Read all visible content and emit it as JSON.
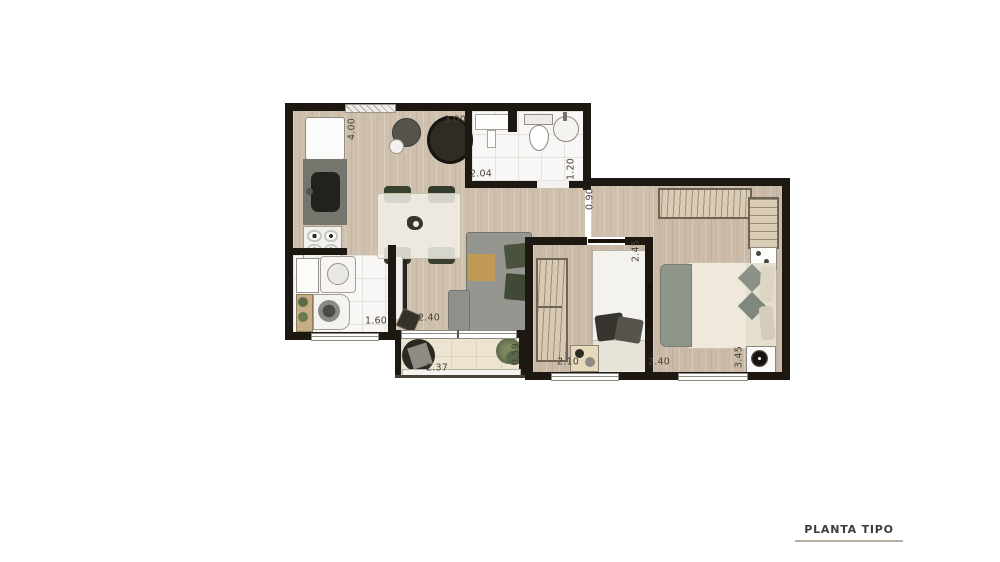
{
  "title": {
    "label": "PLANTA TIPO"
  },
  "dimensions": [
    {
      "id": "kitchen-depth",
      "value": "4.00",
      "orientation": "vertical"
    },
    {
      "id": "living-width",
      "value": "3.00",
      "orientation": "horizontal"
    },
    {
      "id": "bathroom-width",
      "value": "2.04",
      "orientation": "horizontal"
    },
    {
      "id": "bathroom-depth",
      "value": "1.20",
      "orientation": "vertical"
    },
    {
      "id": "hall-width",
      "value": "0.90",
      "orientation": "vertical"
    },
    {
      "id": "bedroom2-depth",
      "value": "2.45",
      "orientation": "vertical"
    },
    {
      "id": "laundry-width",
      "value": "1.60",
      "orientation": "horizontal"
    },
    {
      "id": "living-length",
      "value": "2.40",
      "orientation": "horizontal"
    },
    {
      "id": "balcony-width",
      "value": "2.37",
      "orientation": "horizontal"
    },
    {
      "id": "balcony-depth",
      "value": "0.59",
      "orientation": "vertical"
    },
    {
      "id": "bedroom2-width",
      "value": "2.10",
      "orientation": "horizontal"
    },
    {
      "id": "master-width",
      "value": "2.40",
      "orientation": "horizontal"
    },
    {
      "id": "master-depth",
      "value": "3.45",
      "orientation": "vertical"
    }
  ],
  "colors": {
    "wall": "#1e1813",
    "wood_floor": "#cfc0ad",
    "bedroom_floor": "#cbbaa7",
    "tile_floor": "#f8f7f5",
    "balcony_floor": "#ece3d1",
    "wardrobe": "#dbcdb5",
    "sofa": "#95968f",
    "pillow_green": "#49523d",
    "title_text": "#3f3b37",
    "title_rule": "#b5ada0"
  }
}
